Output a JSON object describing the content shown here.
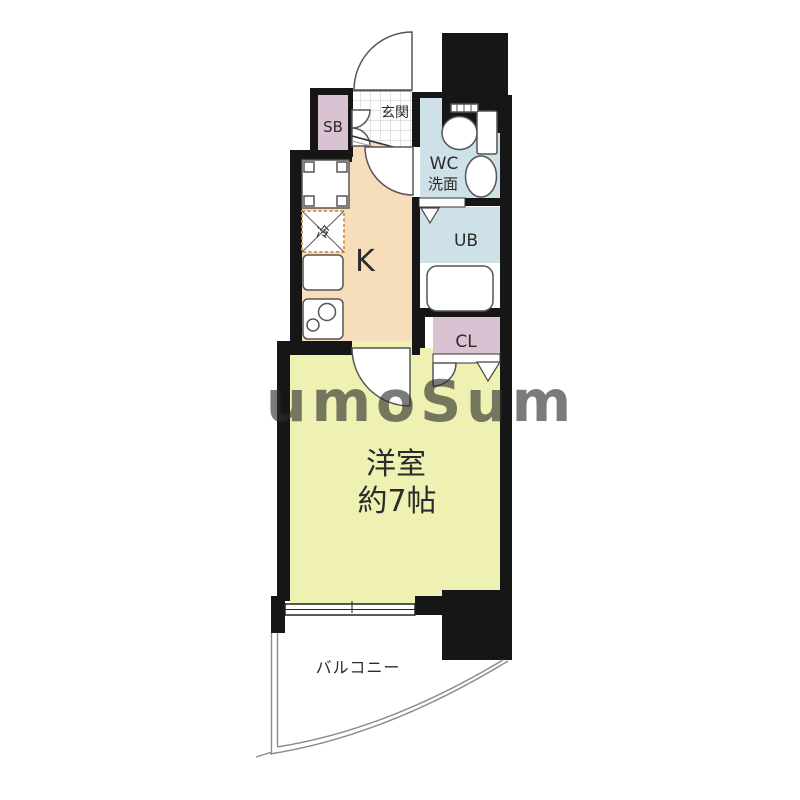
{
  "title": "1K apartment floor plan",
  "colors": {
    "wall": "#161616",
    "kitchen": "#f7debb",
    "room": "#eff1b2",
    "wet": "#cfe1e8",
    "closet": "#d9c3d3",
    "fixture_line": "#555555",
    "fridge_dash": "#d49a5a",
    "watermark": "#ffffff"
  },
  "rooms": {
    "entrance": {
      "label": "玄関"
    },
    "shoebox": {
      "label": "SB"
    },
    "toilet_washroom": {
      "label_line1": "WC",
      "label_line2": "洗面"
    },
    "unit_bath": {
      "label": "UB"
    },
    "closet": {
      "label": "CL"
    },
    "kitchen": {
      "label": "K"
    },
    "refrigerator": {
      "label": "冷"
    },
    "western_room": {
      "label_line1": "洋室",
      "label_line2": "約7帖"
    },
    "balcony": {
      "label": "バルコニー"
    }
  },
  "watermark": {
    "text": "umoSum"
  }
}
